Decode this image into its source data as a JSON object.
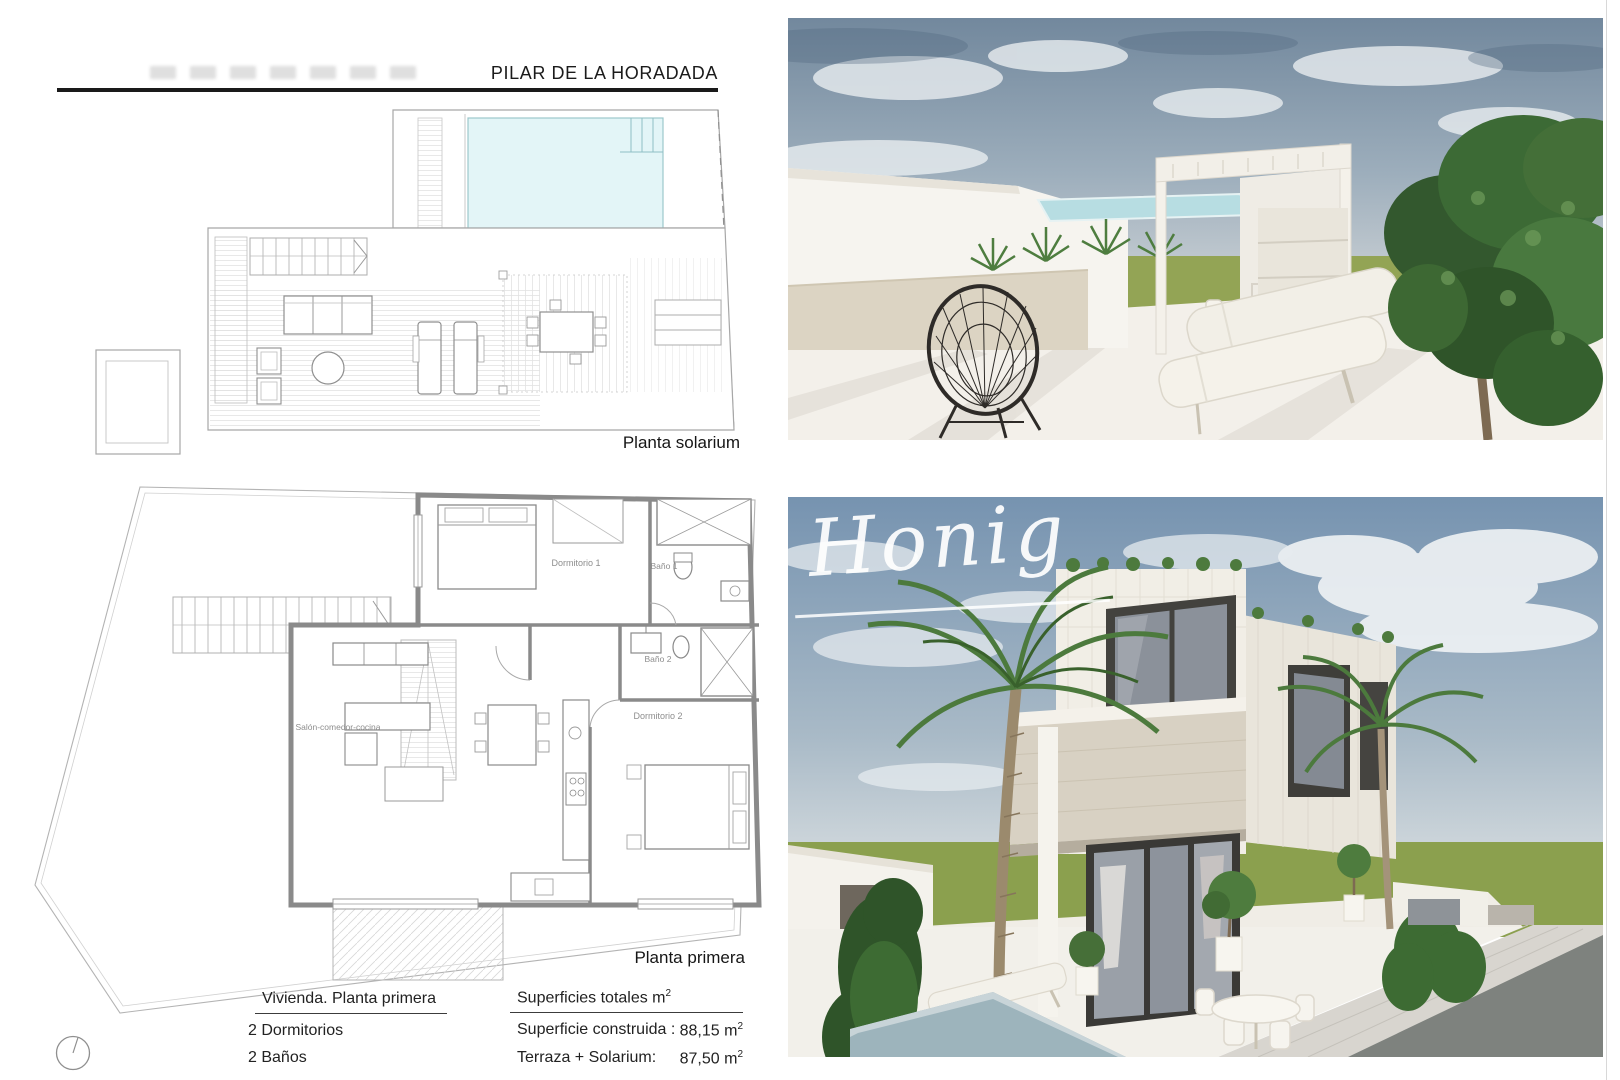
{
  "header": {
    "location": "PILAR DE LA HORADADA"
  },
  "watermark": {
    "text": "Honig"
  },
  "solarium_plan": {
    "caption": "Planta solarium"
  },
  "first_floor_plan": {
    "caption": "Planta primera",
    "room_labels": {
      "dormitorio1": "Dormitorio 1",
      "bano1": "Baño 1",
      "bano2": "Baño 2",
      "dormitorio2": "Dormitorio 2",
      "salon": "Salón-comedor-cocina"
    }
  },
  "specs": {
    "dwelling": {
      "heading": "Vivienda. Planta primera",
      "bedrooms": "2  Dormitorios",
      "bathrooms": "2  Baños"
    },
    "surfaces": {
      "heading": "Superficies totales m",
      "heading_sup": "2",
      "rows": [
        {
          "label": "Superficie construida :",
          "value": "88,15 m",
          "sup": "2"
        },
        {
          "label": "Terraza + Solarium:",
          "value": "87,50 m",
          "sup": "2"
        }
      ]
    }
  },
  "colors": {
    "pool_plan": "#e3f5f7",
    "sky": "#76909f",
    "grass": "#93a455",
    "rule": "#1a1a1a"
  }
}
